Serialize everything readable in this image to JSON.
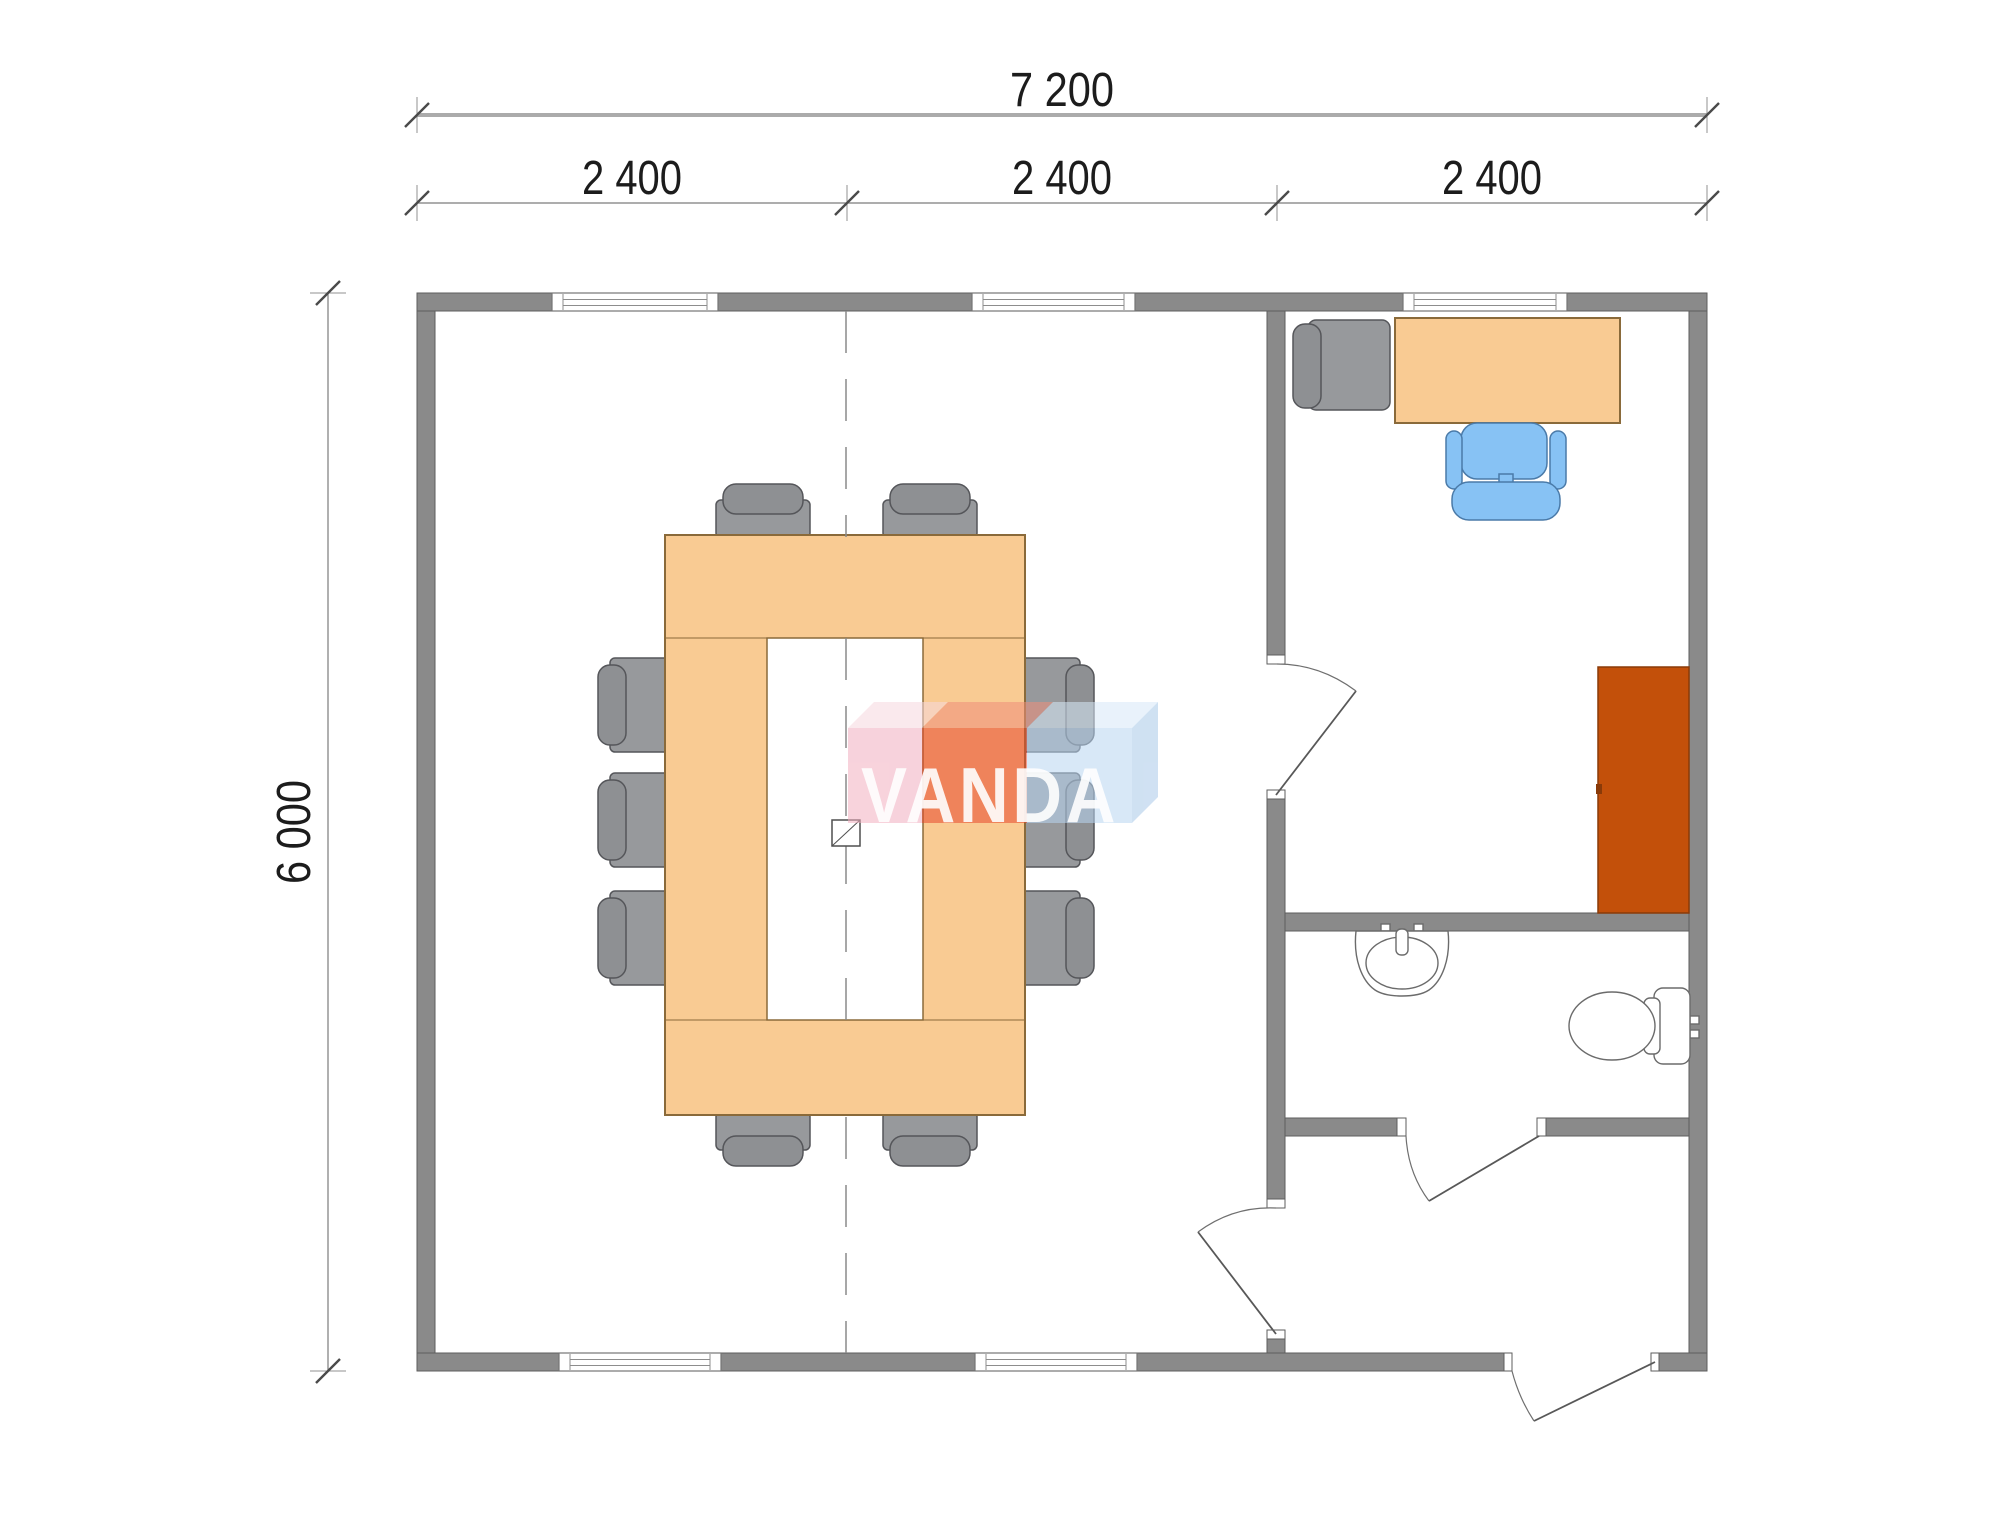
{
  "document": {
    "type": "architectural-floor-plan"
  },
  "dimensions": {
    "overall_width_mm": "7 200",
    "modules_mm": [
      "2 400",
      "2 400",
      "2 400"
    ],
    "overall_depth_mm": "6 000"
  },
  "watermark": {
    "text": "VANDA"
  },
  "plan": {
    "rooms": [
      "meeting-room",
      "office",
      "bathroom",
      "entrance-hall"
    ],
    "counts": {
      "conference_chairs": 10,
      "windows": 5,
      "doors": 4
    },
    "furniture": [
      "conference-table",
      "conference-chairs",
      "office-desk",
      "office-armchair",
      "office-swivel-chair",
      "wardrobe",
      "washbasin",
      "toilet"
    ]
  },
  "colors": {
    "background": "#ffffff",
    "wall": "#8a8a8a",
    "wall_line": "#5e5e5e",
    "table": "#F9CB93",
    "table_line": "#8a6a3a",
    "chair": "#97999c",
    "chair_back": "#8e9093",
    "chair_line": "#55565a",
    "office_chair": "#87C2F4",
    "office_chair_line": "#4a7aa8",
    "wardrobe": "#C3500A",
    "wardrobe_line": "#8a3a08",
    "logo_pink": "#F2AFC0",
    "logo_pink_top": "#F7D8DF",
    "logo_red": "#E84A2E",
    "logo_red_top": "#EF8F7B",
    "logo_blue": "#B9D6F2",
    "logo_blue_top": "#D8E9F8",
    "logo_side": "#A9C9E9",
    "logo_text": "#FFFFFF"
  }
}
